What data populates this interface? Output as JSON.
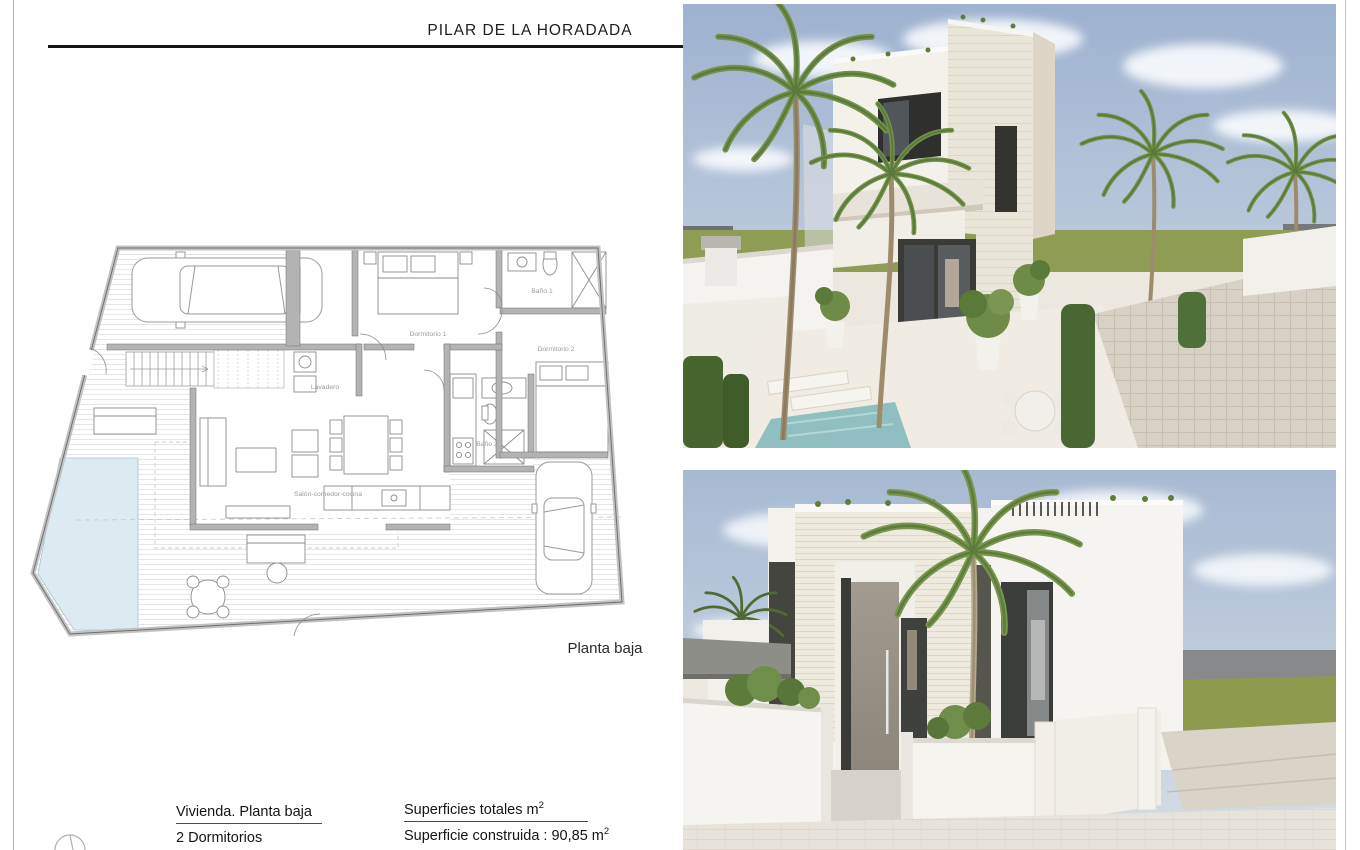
{
  "page": {
    "title": "PILAR DE LA HORADADA",
    "background": "#ffffff",
    "border_color": "#b5b5b5"
  },
  "floor_plan": {
    "caption": "Planta baja",
    "rooms": {
      "dormitorio1": "Dormitorio 1",
      "bano1": "Baño 1",
      "dormitorio2": "Dormitorio 2",
      "lavadero": "Lavadero",
      "bano2": "Baño 2",
      "salon": "Salón-comedor-cocina"
    },
    "colors": {
      "pool": "#dcebf2",
      "wall": "#b3b3b3",
      "outline": "#6e6e6e",
      "label": "#9a9a9a",
      "deck_line": "#e6e6e6"
    }
  },
  "legend": {
    "dwelling_title": "Vivienda. Planta baja",
    "bedrooms": "2  Dormitorios",
    "surfaces_title": "Superficies totales m",
    "surfaces_sup": "2",
    "built_area": "Superficie construida : 90,85 m",
    "built_area_sup": "2"
  },
  "renders": {
    "top": {
      "description": "exterior perspective render of two-storey white villa with palms, pool terrace",
      "sky": "#9db2d0",
      "grass": "#8f9c54",
      "building": "#efeadf",
      "pool": "#8fbfc0",
      "glazing": "#3a3a36",
      "palm": "#74914c"
    },
    "bottom": {
      "description": "street elevation render of white villa with palm, perimeter walls and parked car",
      "sky": "#a7bad3",
      "grass": "#8e9b4f",
      "building": "#f1ede4",
      "door": "#948e83",
      "back_wall": "#87898b",
      "car": "#f1f0ee"
    }
  }
}
